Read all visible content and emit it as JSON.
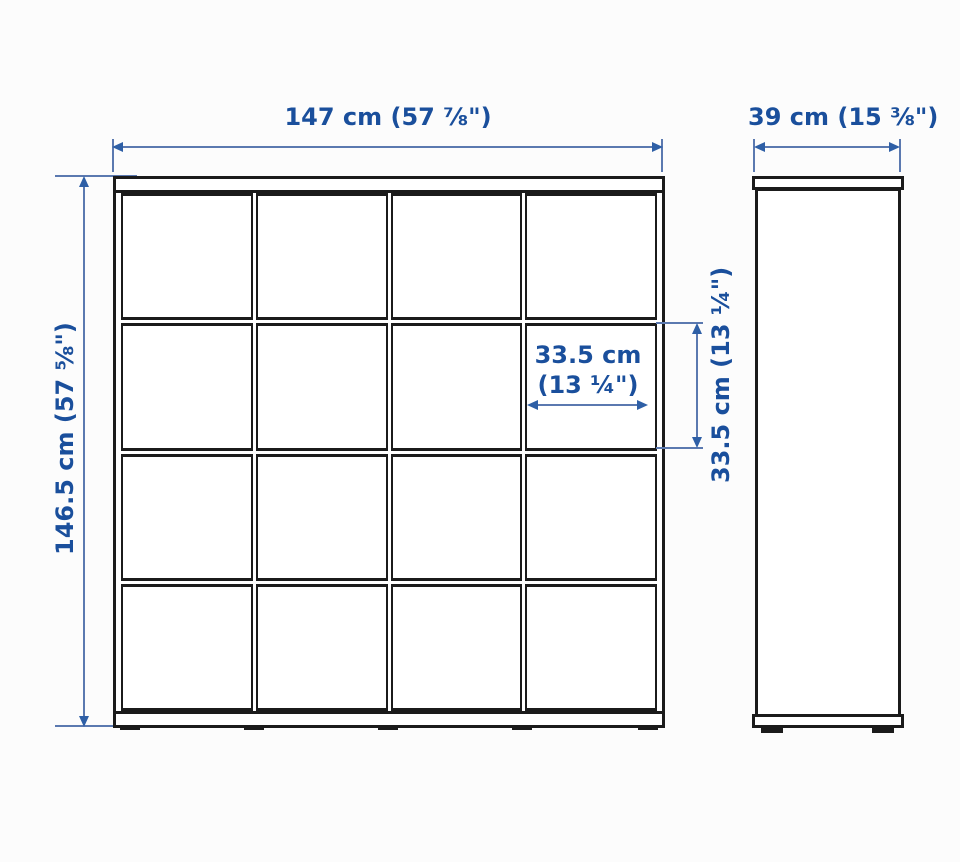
{
  "colors": {
    "background": "#fcfcfc",
    "line": "#1b1b1b",
    "dim_text": "#1a4f9c",
    "dim_line": "#5b79b0",
    "dim_arrow": "#2e5fa6"
  },
  "front_view": {
    "width_label": "147 cm (57 ⅞\")",
    "height_label": "146.5 cm (57 ⅝\")",
    "cell_width_line1": "33.5 cm",
    "cell_width_line2": "(13 ¼\")",
    "cell_height_label": "33.5 cm (13 ¼\")",
    "grid_rows": 4,
    "grid_cols": 4
  },
  "side_view": {
    "depth_label": "39 cm (15 ⅜\")"
  }
}
